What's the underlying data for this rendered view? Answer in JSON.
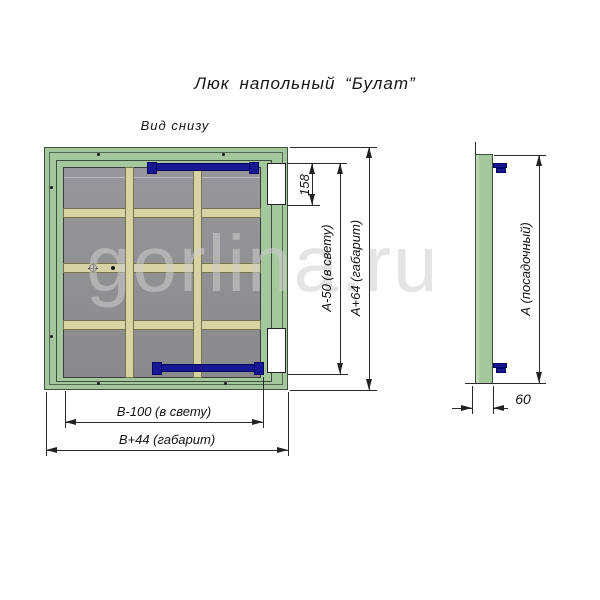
{
  "title": "Люк напольный “Булат”",
  "view_label": "Вид снизу",
  "watermark": "gorlina.ru",
  "dimensions": {
    "hinge_offset": "158",
    "height_clear": "А-50 (в свету)",
    "height_overall": "А+64 (габарит)",
    "width_clear": "В-100 (в свету)",
    "width_overall": "В+44 (габарит)",
    "seat_size": "А (посадочный)",
    "thickness": "60"
  },
  "colors": {
    "frame_green": "#a4c79d",
    "panel_gray": "#8e8e90",
    "stiffener_beige": "#d7d3a4",
    "latch_navy": "#181894",
    "hinge_white": "#ffffff",
    "dim_line": "#2a2a2a",
    "watermark_gray": "#cecece"
  }
}
